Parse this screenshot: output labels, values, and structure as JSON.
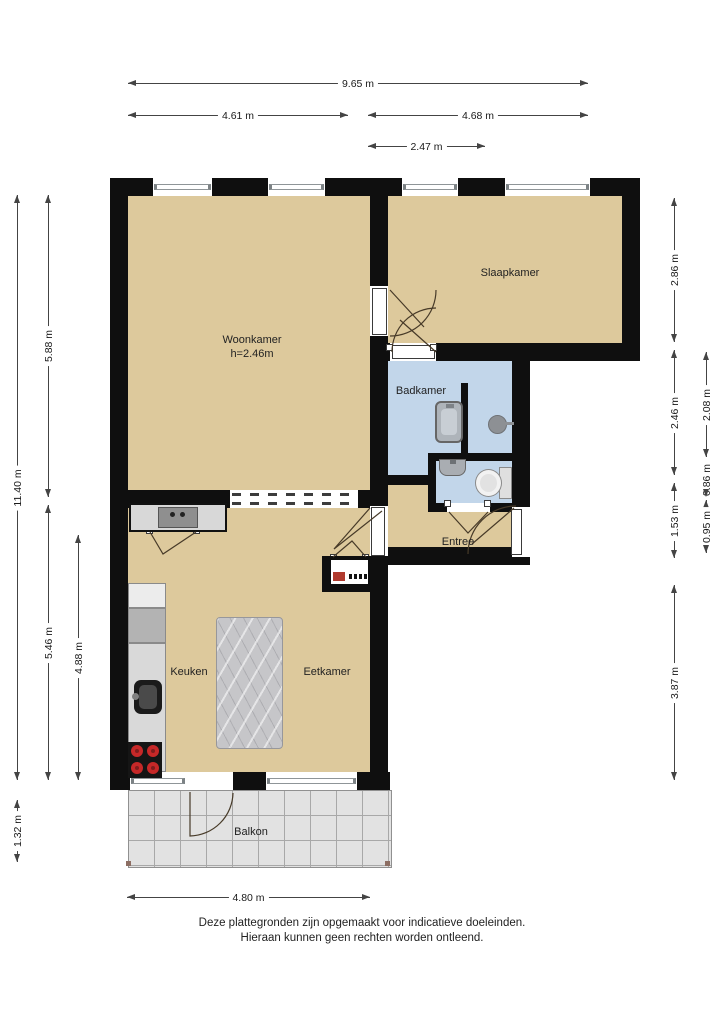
{
  "rooms": {
    "woonkamer": {
      "label": "Woonkamer",
      "sublabel": "h=2.46m"
    },
    "slaapkamer": {
      "label": "Slaapkamer"
    },
    "badkamer": {
      "label": "Badkamer"
    },
    "entree": {
      "label": "Entree"
    },
    "keuken": {
      "label": "Keuken"
    },
    "eetkamer": {
      "label": "Eetkamer"
    },
    "balkon": {
      "label": "Balkon"
    }
  },
  "dimensions": {
    "top_total": "9.65 m",
    "top_left": "4.61 m",
    "top_right": "4.68 m",
    "top_inner": "2.47 m",
    "left_total": "11.40 m",
    "left_upper": "5.88 m",
    "left_lower": "5.46 m",
    "left_inner": "4.88 m",
    "left_balcony": "1.32 m",
    "right_1": "2.86 m",
    "right_2": "2.46 m",
    "right_3": "2.08 m",
    "right_4": "0.86 m",
    "right_5": "1.53 m",
    "right_6": "0.95 m",
    "right_7": "3.87 m",
    "bottom": "4.80 m"
  },
  "footer": {
    "line1": "Deze plattegronden zijn opgemaakt voor indicatieve doeleinden.",
    "line2": "Hieraan kunnen geen rechten worden ontleend."
  },
  "colors": {
    "wall": "#0f0f0f",
    "room": "#ddc99c",
    "wet": "#c2d6ea",
    "balcony": "#e2e2e2",
    "doorline": "#473a28"
  }
}
